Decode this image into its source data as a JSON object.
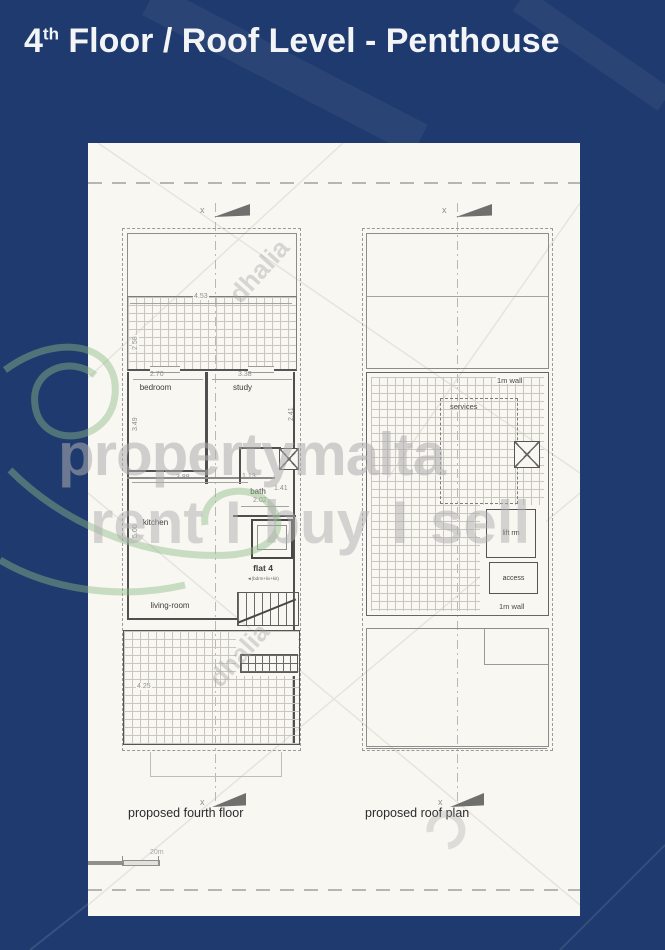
{
  "colors": {
    "background": "#1e3a6e",
    "sheet": "#f8f7f2",
    "watermark_green": "#8cbb84",
    "plan_line": "#4f4f4f"
  },
  "title": {
    "prefix": "4",
    "superscript": "th",
    "suffix": " Floor / Roof Level - Penthouse"
  },
  "sheet": {
    "plans": {
      "fourth_floor": {
        "caption": "proposed fourth floor",
        "section_marker": "x",
        "rooms": {
          "bedroom": "bedroom",
          "study": "study",
          "kitchen": "kitchen",
          "living_room": "living-room",
          "bath": "bath",
          "flat": "flat 4",
          "flat_note": "◄(bdrm+liv+kit)"
        },
        "dims": {
          "terrace_width": "4.53",
          "terrace_depth": "2.58",
          "bedroom_width": "2.70",
          "bedroom_depth": "3.49",
          "study_width": "3.38",
          "study_depth": "2.41",
          "kitchen_width": "3.88",
          "kitchen_depth": "5.00",
          "bath_width": "2.02",
          "bath_depth": "1.41",
          "bath_recess": "1.13",
          "lower_terrace_depth": "4.25"
        }
      },
      "roof": {
        "caption": "proposed roof plan",
        "section_marker": "x",
        "labels": {
          "wall_top": "1m wall",
          "services": "services",
          "lift_room": "lift rm",
          "access": "access",
          "wall_bottom": "1m wall"
        }
      }
    },
    "scale_bar": {
      "label": "20m"
    }
  },
  "watermarks": {
    "brand_line1": "propertymalta",
    "brand_line2": "rent I buy I sell",
    "agency": "dhalia"
  }
}
